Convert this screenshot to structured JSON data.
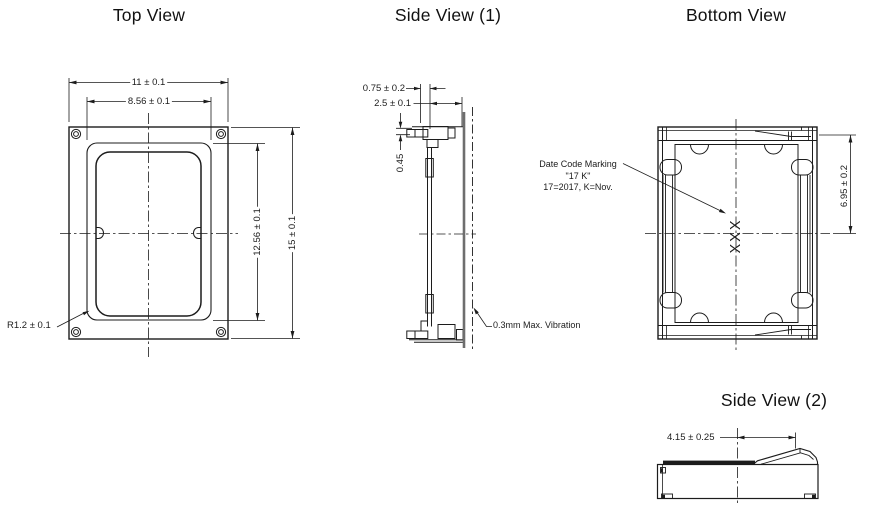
{
  "titles": {
    "top_view": "Top View",
    "side_view_1": "Side View (1)",
    "bottom_view": "Bottom View",
    "side_view_2": "Side View (2)"
  },
  "top_view": {
    "dim_width_outer": "11 ± 0.1",
    "dim_width_inner": "8.56 ± 0.1",
    "dim_height_inner": "12.56 ± 0.1",
    "dim_height_outer": "15 ± 0.1",
    "dim_corner_radius": "R1.2 ± 0.1"
  },
  "side_view_1": {
    "dim_tab_offset": "0.75 ± 0.2",
    "dim_depth": "2.5 ± 0.1",
    "dim_tab_thickness": "0.45",
    "vibration_note": "0.3mm Max. Vibration"
  },
  "bottom_view": {
    "date_code_label": "Date Code Marking",
    "date_code_example": "\"17 K\"",
    "date_code_legend": "17=2017, K=Nov.",
    "marking": "XXX",
    "dim_half_height": "6.95 ± 0.2"
  },
  "side_view_2": {
    "dim_port_offset": "4.15 ± 0.25"
  },
  "colors": {
    "line": "#1c1c1c",
    "background": "#ffffff"
  }
}
